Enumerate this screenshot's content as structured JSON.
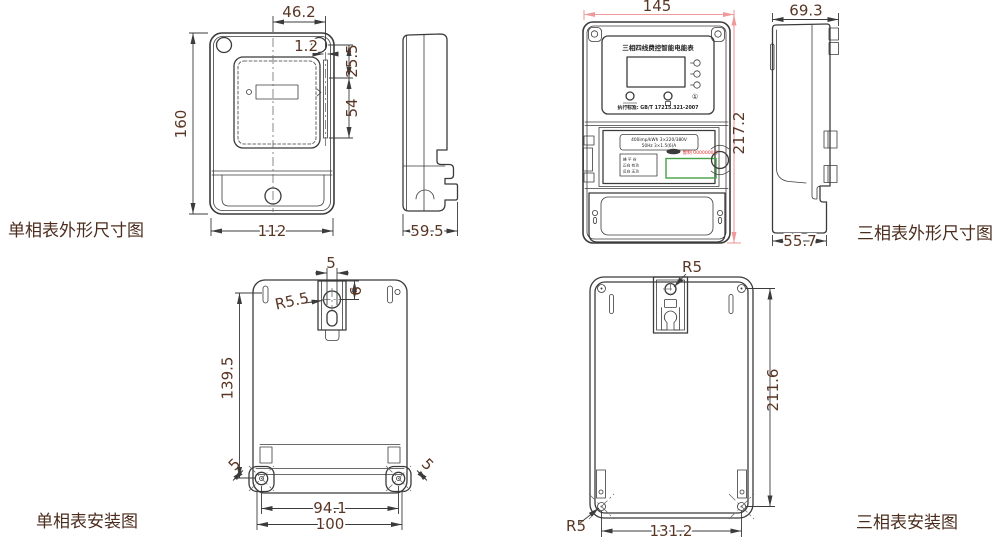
{
  "colors": {
    "line": "#3b3b3b",
    "dim_text": "#5a3624",
    "caption_text": "#4b2c1d",
    "red_dim": "#ef9a9a",
    "serial_red": "#e53030",
    "green_box": "#46a046"
  },
  "captions": {
    "single_outline": "单相表外形尺寸图",
    "three_outline": "三相表外形尺寸图",
    "single_install": "单相表安装图",
    "three_install": "三相表安装图"
  },
  "single_front": {
    "dims": {
      "height": "160",
      "width": "112",
      "top_width": "46.2",
      "strip_width": "1.2",
      "upper_offset": "25.5",
      "strip_length": "54"
    }
  },
  "single_side": {
    "dims": {
      "depth": "59.5"
    }
  },
  "three_front": {
    "panel": {
      "title": "三相四线费控智能电能表",
      "standard": "执行标准: GB/T 17215.321-2007",
      "power_button": "①"
    },
    "nameplate": {
      "spec_line1": "400imp/kWh  3×220/380V",
      "spec_line2": "50Hz  3×1.5(6)A",
      "table_rows": [
        "峰 平 谷",
        "正向 有功",
        "反向 无功"
      ],
      "serial": "鲁制 0000000号"
    },
    "dims": {
      "width": "145",
      "height": "217.2"
    }
  },
  "three_side": {
    "dims": {
      "top_depth": "69.3",
      "bottom_depth": "55.7"
    }
  },
  "single_install": {
    "dims": {
      "slot_width": "5",
      "hole_depth": "6",
      "hole_radius": "R5.5",
      "height": "139.5",
      "ear_left": "5",
      "ear_right": "5",
      "hole_span": "94.1",
      "width": "100"
    }
  },
  "three_install": {
    "dims": {
      "radius_top": "R5",
      "radius_bottom": "R5",
      "height": "211.6",
      "width": "131.2"
    }
  }
}
